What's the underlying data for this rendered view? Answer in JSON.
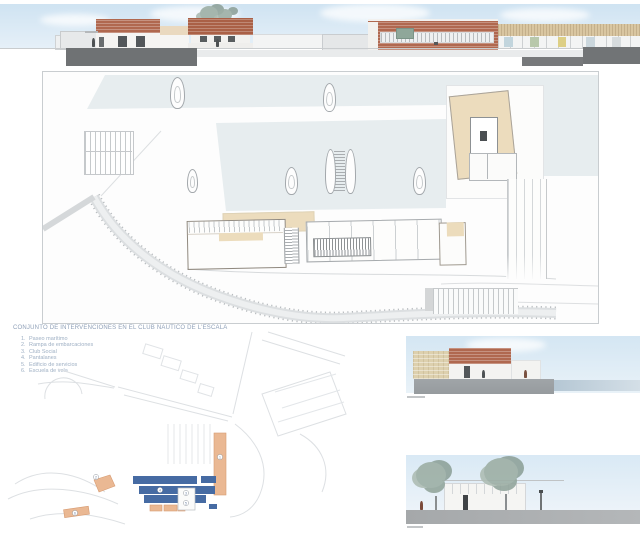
{
  "legend": {
    "title": "CONJUNTO DE INTERVENCIONES EN EL CLUB NAUTICO DE L'ESCALA",
    "items": [
      {
        "num": "1.",
        "label": "Paseo marítimo"
      },
      {
        "num": "2.",
        "label": "Rampa de embarcaciones"
      },
      {
        "num": "3.",
        "label": "Club Social"
      },
      {
        "num": "4.",
        "label": "Pantalanes"
      },
      {
        "num": "5.",
        "label": "Edificio de servicios"
      },
      {
        "num": "6.",
        "label": "Escuela de vela"
      }
    ]
  },
  "plan": {
    "markers": [
      "1",
      "2",
      "3",
      "4",
      "5",
      "6"
    ]
  },
  "colors": {
    "sky": "#d7e8f3",
    "water_plan": "#e7edef",
    "brick": "#b0684f",
    "timber": "#d9c6a1",
    "sandstone": "#ddd0ae",
    "roof_tan": "#ecdcbd",
    "quay_dark": "#6f7274",
    "marina_blue": "#466ba3",
    "intervention_orange": "#eab893",
    "base_grey": "#a7aaac"
  }
}
